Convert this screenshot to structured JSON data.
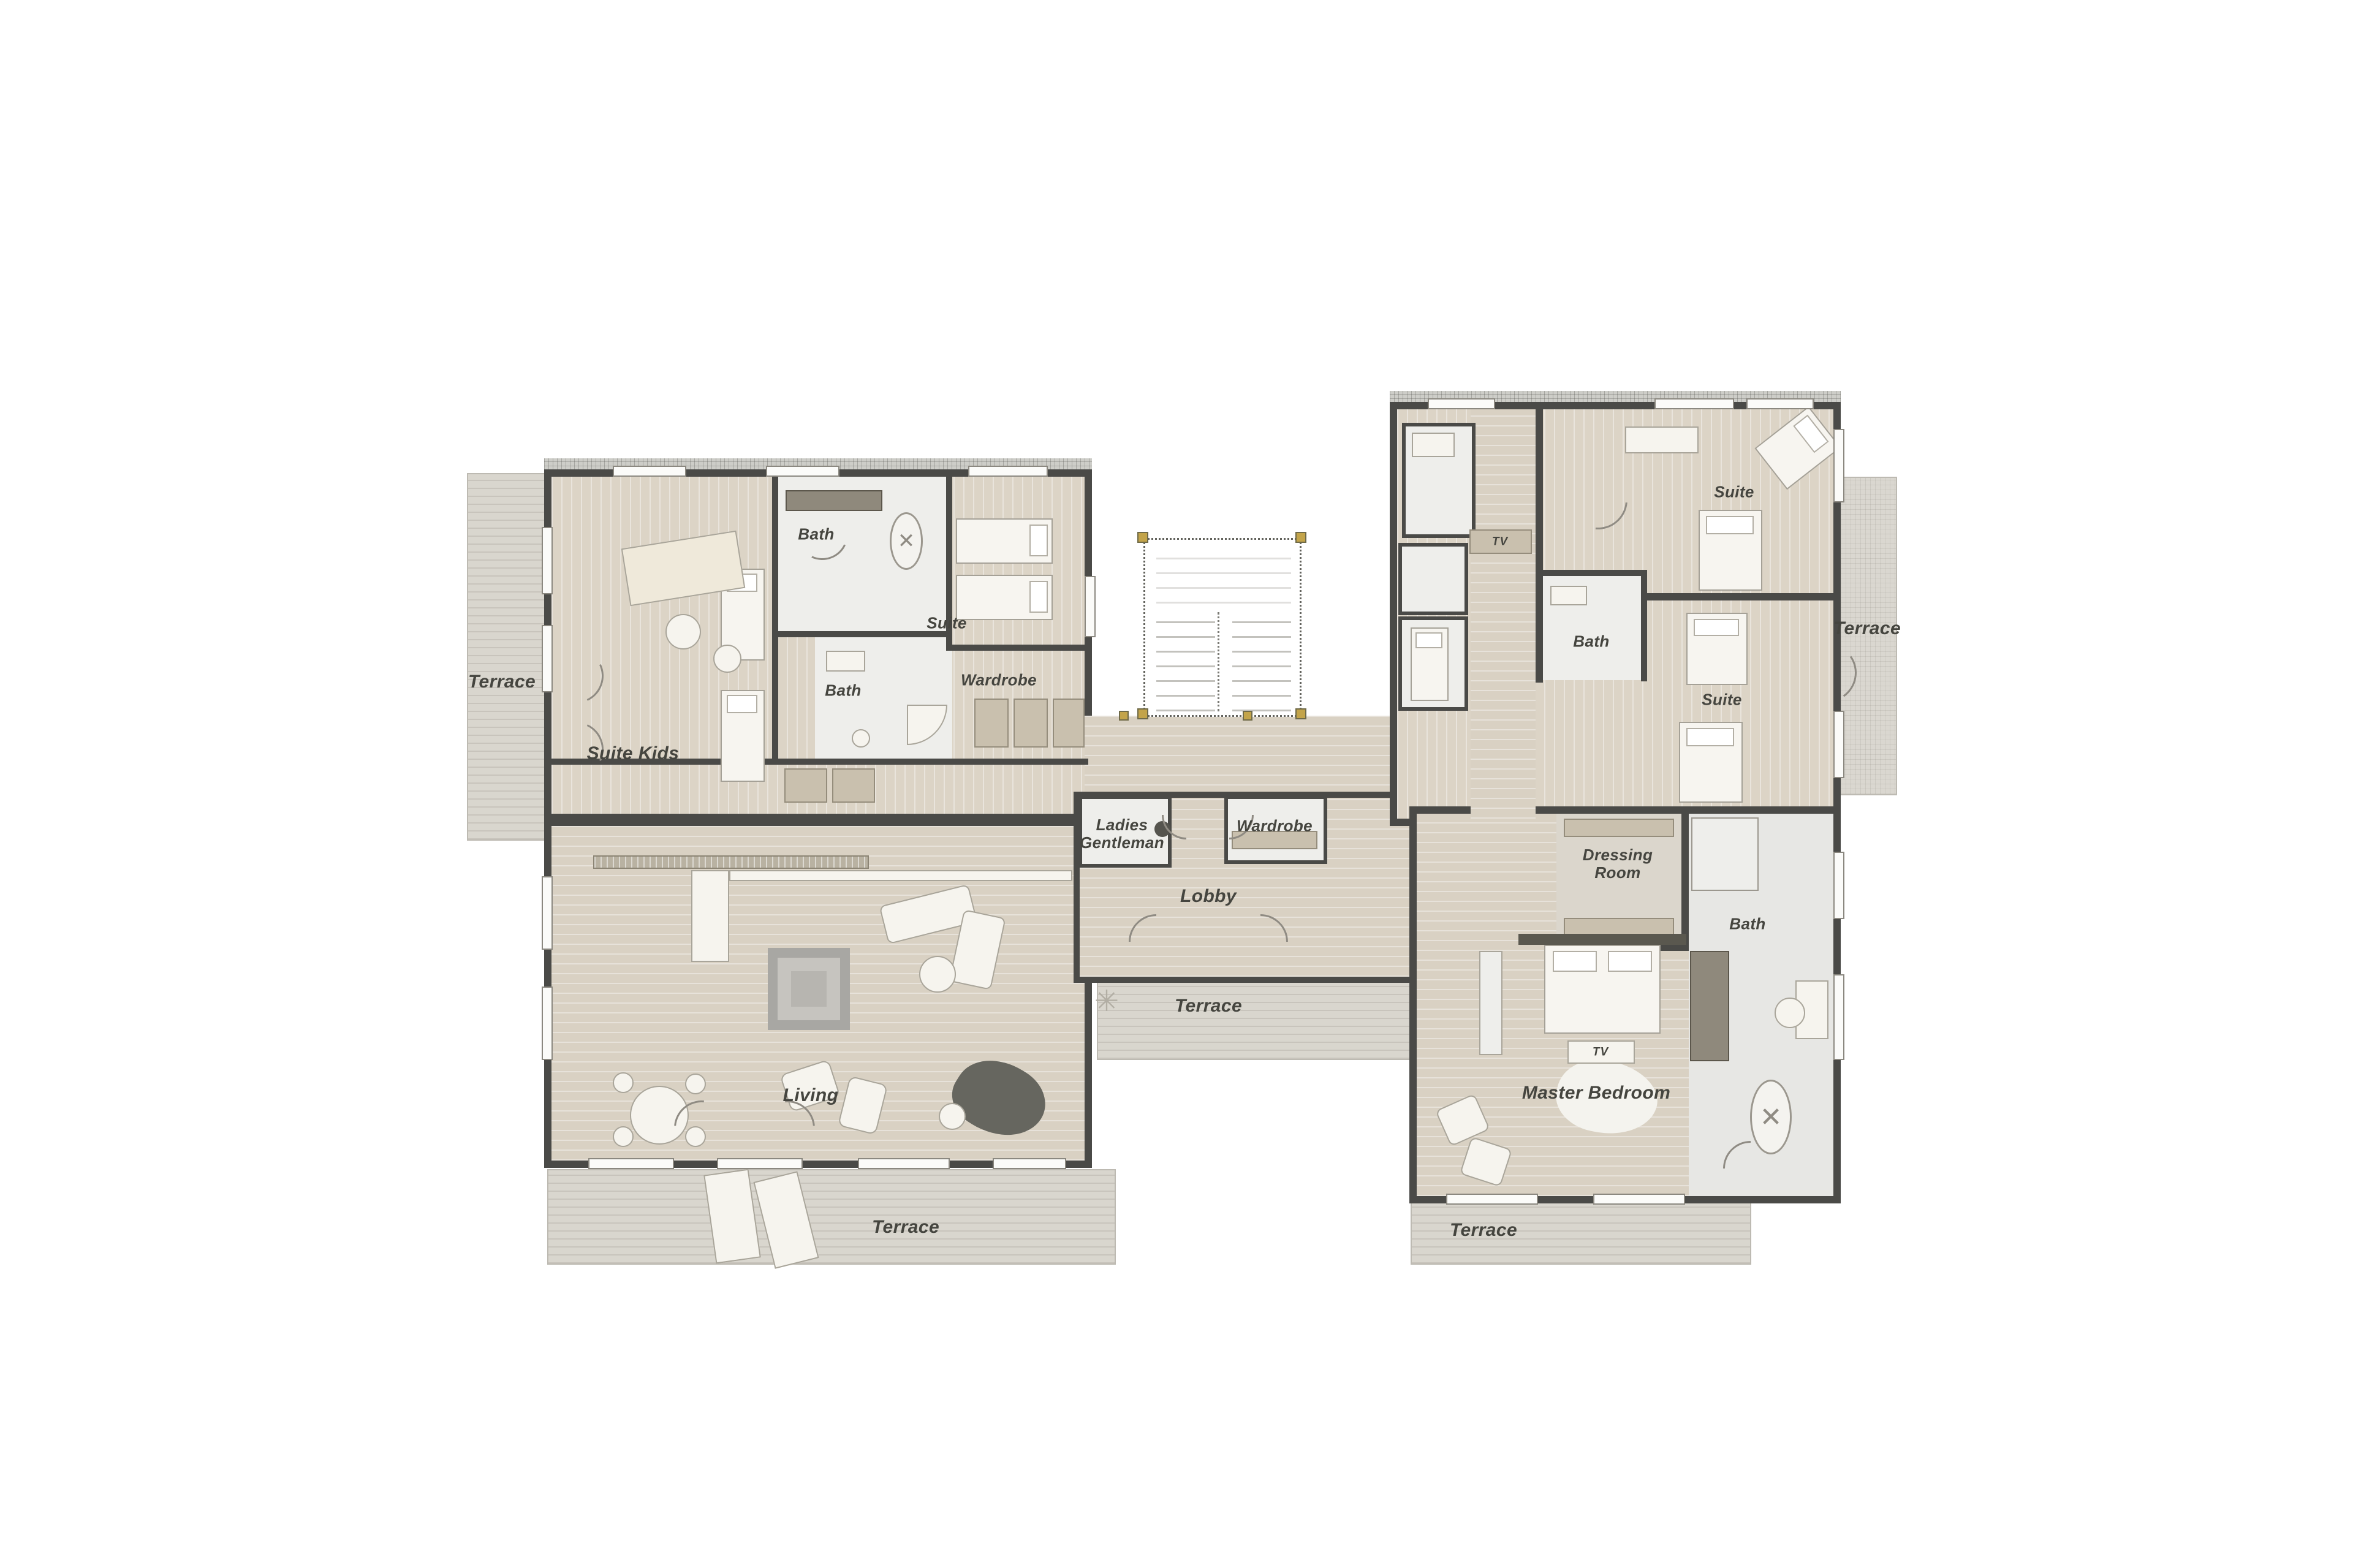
{
  "document": {
    "type": "architectural-floor-plan",
    "description": "Penthouse floor plan with two wings connected by a central lobby and stair core"
  },
  "labels": {
    "terrace_left": "Terrace",
    "suite_kids": "Suite Kids",
    "bath_kids": "Bath",
    "bath_inner": "Bath",
    "suite_left": "Suite",
    "wardrobe_left": "Wardrobe",
    "ladies": "Ladies",
    "gentleman": "Gentleman",
    "wardrobe_lobby": "Wardrobe",
    "lobby": "Lobby",
    "terrace_center": "Terrace",
    "living": "Living",
    "terrace_bottom_left": "Terrace",
    "master_bedroom": "Master Bedroom",
    "tv_master": "TV",
    "tv_corridor": "TV",
    "dressing_line1": "Dressing",
    "dressing_line2": "Room",
    "bath_master": "Bath",
    "suite_right_top": "Suite",
    "bath_right": "Bath",
    "suite_right_bottom": "Suite",
    "terrace_right": "Terrace",
    "terrace_bottom_right": "Terrace"
  },
  "palette": {
    "background": "#ffffff",
    "wall": "#4a4a47",
    "floor_wood": "#dcd4c6",
    "floor_corridor": "#d9d1c3",
    "terrace": "#d9d6ce",
    "room_white": "#eeeeeb",
    "room_gray": "#e7e7e4",
    "furniture_outline": "#a9a59a",
    "cabinet_tan": "#c9c0ae",
    "cabinet_dark": "#8f897c",
    "label_text": "#45453f",
    "stair_post_yellow": "#c3a44a",
    "piano_dark": "#66665f"
  }
}
